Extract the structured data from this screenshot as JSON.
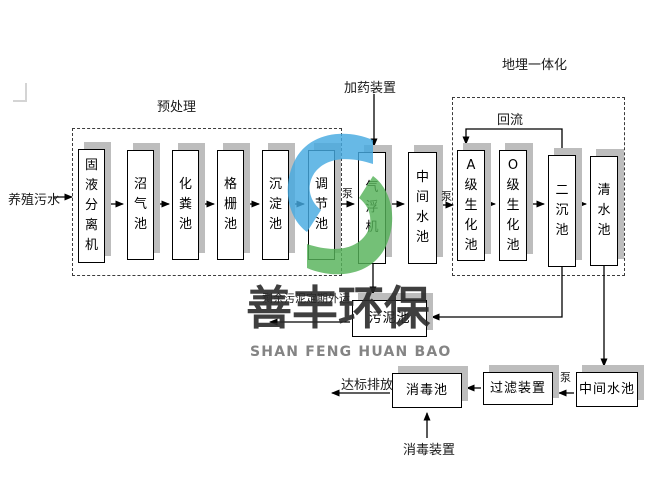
{
  "watermark": {
    "cn": "善丰环保",
    "en": "SHAN FENG HUAN BAO",
    "logo_blue": "#45a9e1",
    "logo_green": "#55b259"
  },
  "labels": {
    "influent": "养殖污水",
    "pretreatment": "预处理",
    "dosing_device": "加药装置",
    "buried_integration": "地埋一体化",
    "reflux": "回流",
    "pump": "泵",
    "sludge_disposal": "剩余污泥定期外运",
    "discharge": "达标排放",
    "disinfection_device": "消毒装置"
  },
  "boxes": {
    "solid_liquid_separator": "固液分离机",
    "biogas_tank": "沼气池",
    "septic_tank": "化粪池",
    "grille_tank": "格栅池",
    "sedimentation_tank": "沉淀池",
    "regulating_tank": "调节池",
    "air_flotation_machine": "气浮机",
    "intermediate_tank_1": "中间水池",
    "a_biochemical_tank": "A级生化池",
    "o_biochemical_tank": "O级生化池",
    "secondary_sedimentation_tank": "二沉池",
    "clear_water_tank": "清水池",
    "sludge_tank": "污泥池",
    "disinfection_tank": "消毒池",
    "filter_device": "过滤装置",
    "intermediate_tank_2": "中间水池"
  }
}
